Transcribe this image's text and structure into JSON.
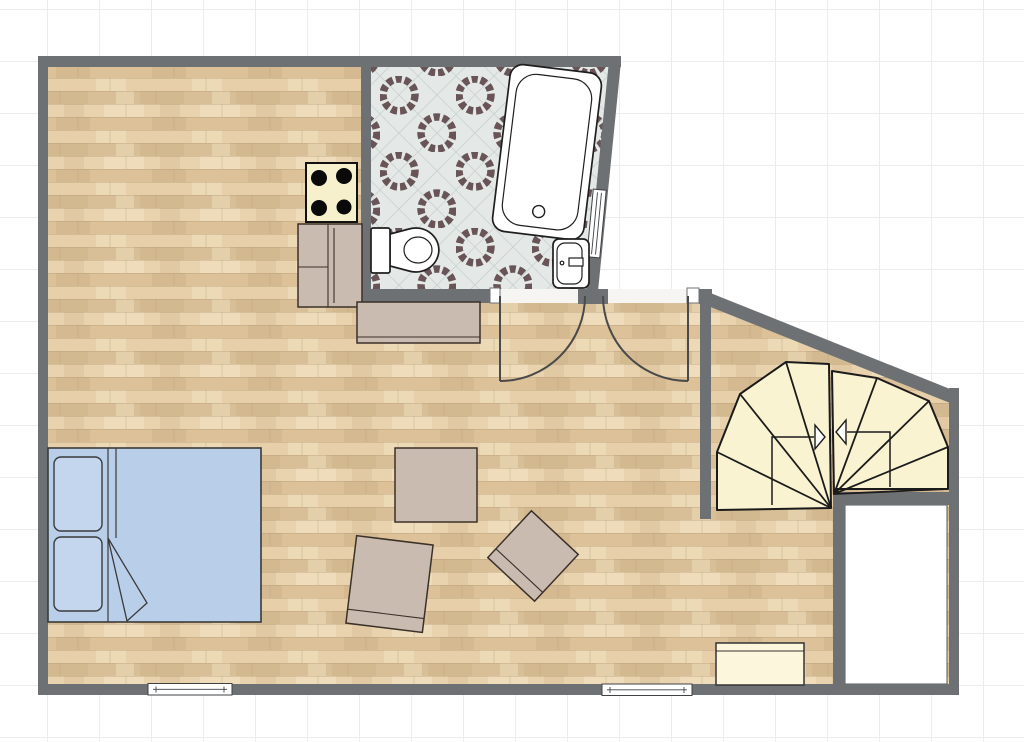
{
  "canvas": {
    "width": 1024,
    "height": 742,
    "grid_cell_px": 52,
    "background": "#ffffff"
  },
  "colors": {
    "grid": "#ececec",
    "wall": "#6e7174",
    "outline": "#222222",
    "door": "#4a4a4a",
    "threshold": "#f6f5f2",
    "window_frame": "#3f4245",
    "wood_base": "#e2cba4",
    "wood_row_a": "#e8d3ae",
    "wood_row_b": "#dcc199",
    "wood_row_c": "#e6cfa9",
    "wood_row_d": "#d9bf97",
    "wood_streak_light": "#f2e3c4",
    "wood_streak_dark": "#c9ad84",
    "wood_seam": "#b2946e",
    "tile_base": "#e4e9e7",
    "tile_ring": "#5c4547",
    "tile_lattice": "#c9d2cf",
    "fixture_white": "#ffffff",
    "fixture_outline": "#1f1f1f",
    "bed_blue": "#b9cfe9",
    "pillow_blue": "#c3d6ee",
    "bed_outline": "#3a3a3a",
    "taupe": "#cabbb1",
    "taupe_outline": "#3a3128",
    "stove_cream": "#f6f0cd",
    "stair_cream": "#faf3d1",
    "bench_cream": "#fcf7dc",
    "arrow": "#1b1b1b",
    "void_border": "#53575a"
  },
  "rooms": [
    {
      "name": "living-room",
      "floor": "wood-plank"
    },
    {
      "name": "bathroom",
      "floor": "octagon-mosaic-tile"
    },
    {
      "name": "stair-hall",
      "floor": "wood-plank"
    }
  ],
  "fixtures": {
    "bathroom": [
      "bathtub",
      "toilet",
      "sink",
      "slanted-wall-window"
    ],
    "kitchen": [
      "cooktop-4-burners",
      "kitchen-counter",
      "console-table"
    ],
    "living": [
      "double-bed",
      "pillow-top",
      "pillow-bottom",
      "blanket-fold",
      "square-table",
      "stool-tilted",
      "stool-diamond"
    ],
    "stair_hall": [
      "winder-staircase",
      "walk-line-up",
      "walk-line-down",
      "under-stair-void",
      "storage-bench"
    ],
    "openings": [
      "bathroom-door",
      "entrance-door",
      "window-bottom-left",
      "window-bottom-right"
    ]
  },
  "staircase": {
    "steps": 9,
    "direction_arrows": [
      "right",
      "left"
    ]
  }
}
